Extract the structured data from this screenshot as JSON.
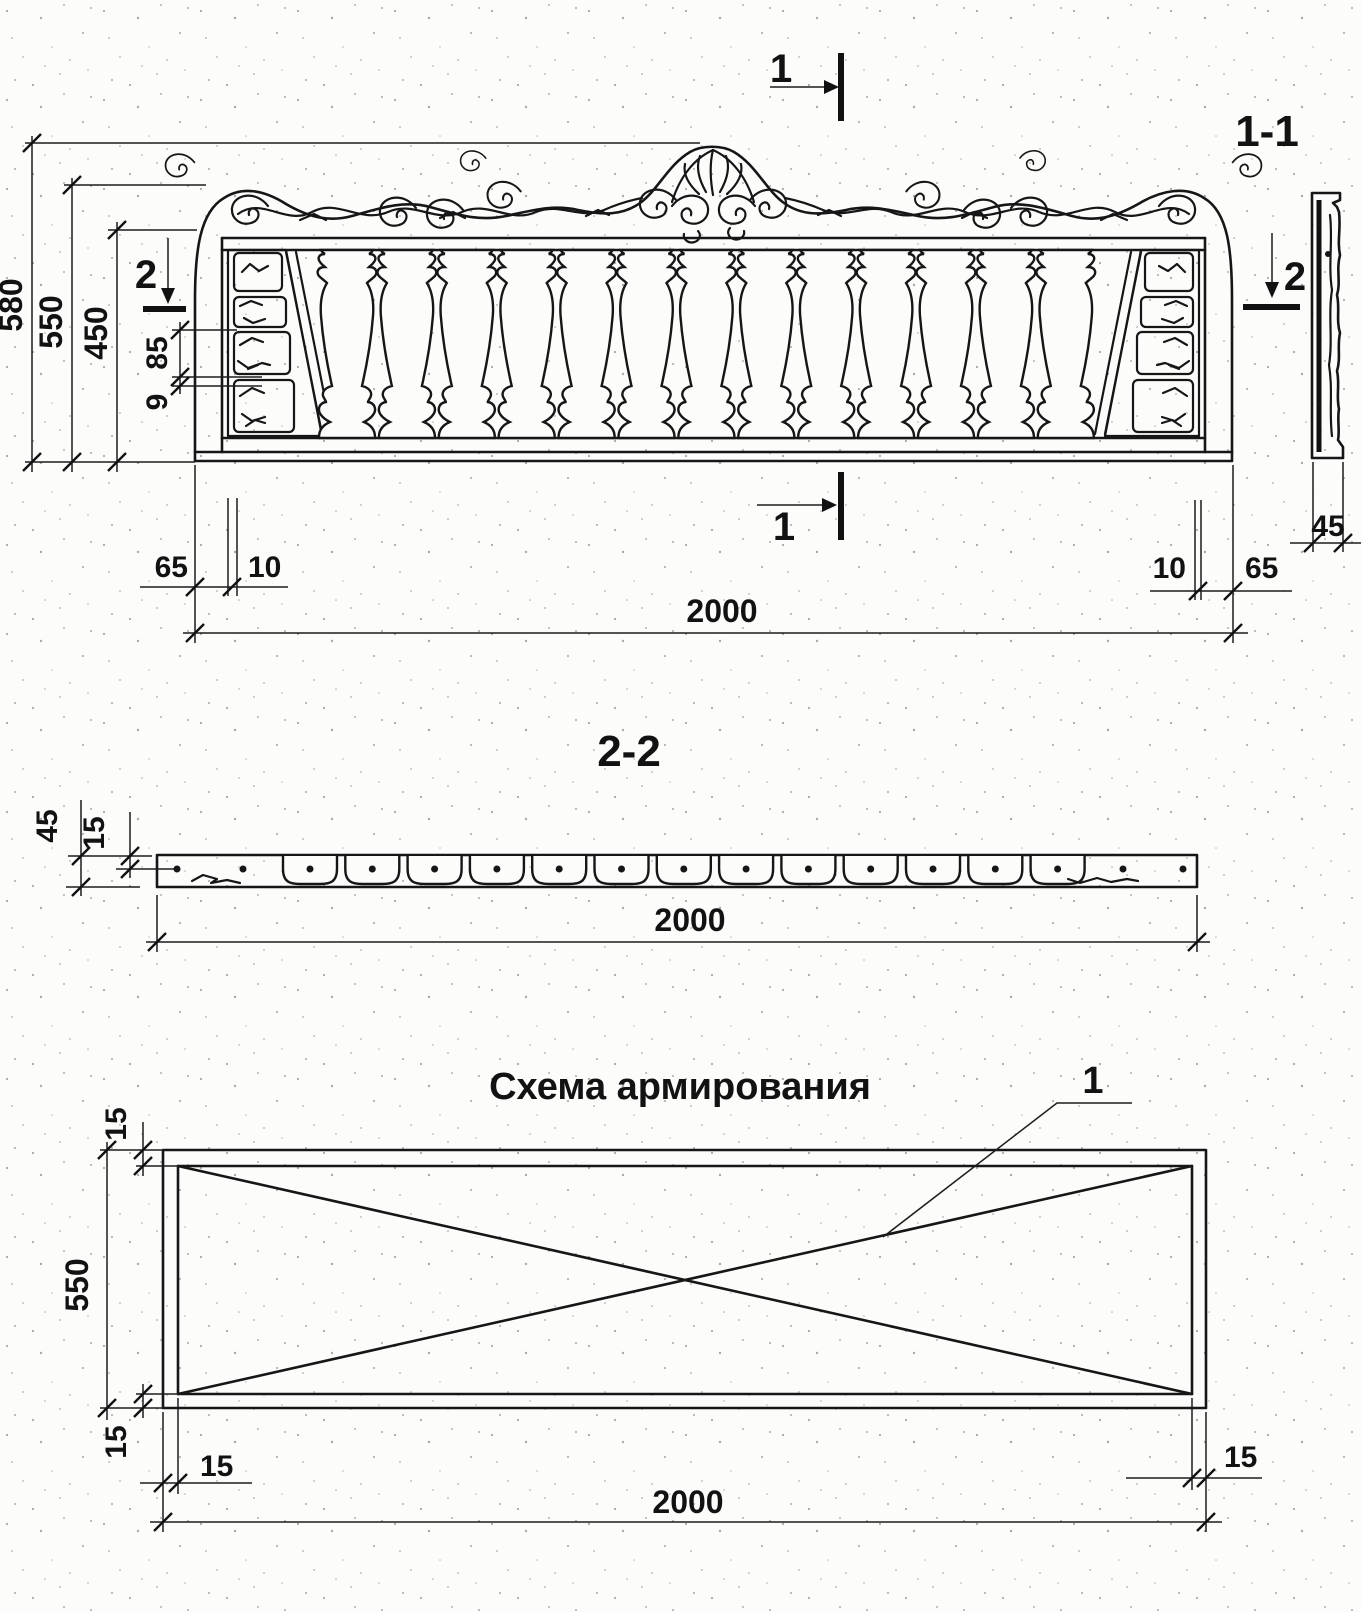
{
  "elevation": {
    "markers": {
      "top": "1",
      "bottom": "1",
      "left": "2",
      "right": "2"
    },
    "dims": {
      "d580": "580",
      "d550": "550",
      "d450": "450",
      "d85": "85",
      "d9": "9",
      "left65": "65",
      "left10": "10",
      "d2000": "2000",
      "right10": "10",
      "right65": "65"
    },
    "balusters_count": 13
  },
  "side": {
    "label": "1-1",
    "dim45": "45",
    "marker": "2"
  },
  "plan": {
    "label": "2-2",
    "dim45": "45",
    "dim15": "15",
    "d2000": "2000",
    "cuts_count": 13
  },
  "reinf": {
    "title": "Схема армирования",
    "callout": "1",
    "top15": "15",
    "d550": "550",
    "bottom15": "15",
    "left15": "15",
    "d2000": "2000",
    "right15": "15"
  }
}
